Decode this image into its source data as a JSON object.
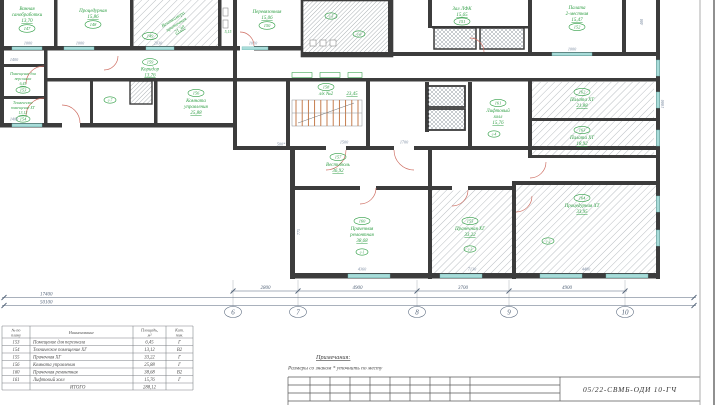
{
  "colors": {
    "label_green": "#2f9e44",
    "dimension_blue": "#7a8aa0",
    "wall": "#3c3c3c",
    "window_cyan": "#a8dcd9",
    "stair_orange": "#c0703c",
    "door_red": "#cd6a5e"
  },
  "rooms": [
    {
      "num": "147",
      "l1": "Ванная",
      "l2": "санобработки",
      "area": "13,70"
    },
    {
      "num": "148",
      "l1": "Процедурная",
      "l2": "",
      "area": "15,86"
    },
    {
      "num": "149",
      "l1": "Венткамера",
      "l2": "приточная",
      "area": "21,30"
    },
    {
      "num": "150",
      "l1": "Перевязочная",
      "l2": "",
      "area": "15,06"
    },
    {
      "num": "151",
      "l1": "Зал ЛФК",
      "l2": "",
      "area": "15,65"
    },
    {
      "num": "152",
      "l1": "Палата",
      "l2": "2-местная",
      "area": "15,47"
    },
    {
      "num": "153",
      "l1": "Помещение для",
      "l2": "персонала",
      "area": "6,45"
    },
    {
      "num": "154",
      "l1": "Техническое",
      "l2": "помещение ХГ",
      "area": "13,12"
    },
    {
      "num": "159",
      "l1": "Коридор",
      "l2": "",
      "area": "13,76"
    },
    {
      "num": "158",
      "l1": "л/к №2",
      "l2": "",
      "area": "23,45"
    },
    {
      "num": "157",
      "l1": "Вестибюль",
      "l2": "",
      "area": "36,92"
    },
    {
      "num": "160",
      "l1": "Прачечная",
      "l2": "ремонтная",
      "area": "38,68"
    },
    {
      "num": "155",
      "l1": "Прачечная ХГ",
      "l2": "",
      "area": "33,22"
    },
    {
      "num": "161",
      "l1": "Лифтовый",
      "l2": "холл",
      "area": "15,76"
    },
    {
      "num": "162",
      "l1": "Палата ХТ",
      "l2": "",
      "area": "21,88"
    },
    {
      "num": "163",
      "l1": "Палата ХТ",
      "l2": "",
      "area": "18,92"
    },
    {
      "num": "164",
      "l1": "Процедурная ХТ",
      "l2": "",
      "area": "33,95"
    },
    {
      "num": "156",
      "l1": "Комната",
      "l2": "управления",
      "area": "25,88"
    },
    {
      "num": "",
      "l1": "",
      "l2": "",
      "area": "5,15"
    }
  ],
  "marks": [
    "с-7",
    "с-5",
    "с-6",
    "с-4",
    "с-1",
    "с-3",
    "с-2"
  ],
  "dims": [
    "1000",
    "1000",
    "2030",
    "1010",
    "1000",
    "1400",
    "1400",
    "500*",
    "1500",
    "1700",
    "775",
    "4360",
    "7130",
    "4480",
    "400",
    "1000"
  ],
  "axes": {
    "bubbles": [
      "6",
      "7",
      "8",
      "9",
      "10"
    ],
    "dims": [
      "2800",
      "4900",
      "3700",
      "4900"
    ],
    "left_dims": [
      "17400",
      "50100"
    ]
  },
  "table": {
    "headers": [
      "№ по плану",
      "Наименование",
      "Площадь, м²",
      "Кат. пом."
    ],
    "headers_lines": [
      [
        "№ по",
        "плану"
      ],
      [
        "Наименование"
      ],
      [
        "Площадь,",
        "м²"
      ],
      [
        "Кат.",
        "пом."
      ]
    ],
    "rows": [
      [
        "153",
        "Помещение для персонала",
        "6,45",
        "Г"
      ],
      [
        "154",
        "Техническое помещение ХГ",
        "13,12",
        "В2"
      ],
      [
        "155",
        "Прачечная ХГ",
        "33,22",
        "Г"
      ],
      [
        "156",
        "Комната управления",
        "25,88",
        "Г"
      ],
      [
        "160",
        "Прачечная ремонтная",
        "38,68",
        "В2"
      ],
      [
        "161",
        "Лифтовый холл",
        "15,76",
        "Г"
      ],
      [
        "",
        "ИТОГО",
        "288,12",
        ""
      ]
    ]
  },
  "notes": {
    "title": "Примечания:",
    "body": "Размеры со знаком * уточнить по месту"
  },
  "stamp": {
    "code": "05/22-СВМБ-ОДИ 10-ГЧ"
  }
}
